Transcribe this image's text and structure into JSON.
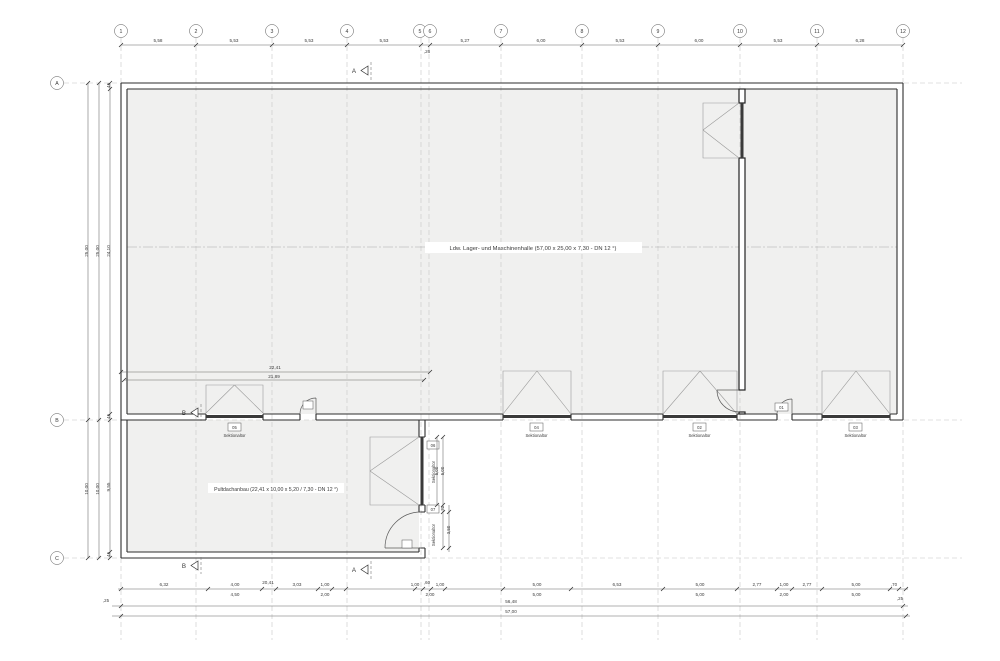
{
  "labels": {
    "hall": "Ldw. Lager- und Maschinenhalle (57,00 x 25,00 x 7,30 - DN 12 °)",
    "annex": "Pultdachanbau (22,41 x 10,00 x 5,20 / 7,30 - DN 12 °)"
  },
  "grid": {
    "top": [
      "1",
      "2",
      "3",
      "4",
      "5",
      "6",
      "7",
      "8",
      "9",
      "10",
      "11",
      "12"
    ],
    "left": [
      "A",
      "B",
      "C"
    ]
  },
  "dims": {
    "top": [
      "5,58",
      "5,53",
      "5,53",
      "5,53",
      ",26",
      "5,27",
      "6,00",
      "5,53",
      "6,00",
      "5,53",
      "6,28"
    ],
    "left_ab": [
      "25,00",
      "25,00",
      "24,10"
    ],
    "left_bc": [
      "10,00",
      "10,00",
      "9,55"
    ],
    "wall_small": ",45",
    "annex_width": [
      "22,41",
      "21,89"
    ],
    "bottom_row1": [
      ",25",
      "6,32",
      "4,00",
      "20,41",
      "3,03",
      "1,00",
      "1,00",
      ",60",
      "1,00",
      "5,00",
      "6,53",
      "5,00",
      "2,77",
      "1,00",
      "2,77",
      "5,00",
      ",70",
      ",25"
    ],
    "bottom_row2": [
      "4,50",
      "2,00",
      "2,00",
      "5,00",
      "5,00",
      "2,00",
      "5,00"
    ],
    "total_inner": "56,48",
    "total_outer": "57,00",
    "east": [
      "5,00",
      "5,00",
      ",70",
      "3,50"
    ]
  },
  "doors": {
    "sektionaltor": "Sektionaltor",
    "numbers": {
      "d01": "01",
      "d02": "02",
      "d03": "03",
      "d04": "04",
      "d05": "05",
      "d06": "06",
      "d07": "07"
    }
  },
  "sections": {
    "a": "A",
    "b": "B"
  },
  "colors": {
    "plan_fill": "#f0f0ef",
    "line": "#2e2e2e",
    "grid_dash": "#c6c6c6"
  }
}
